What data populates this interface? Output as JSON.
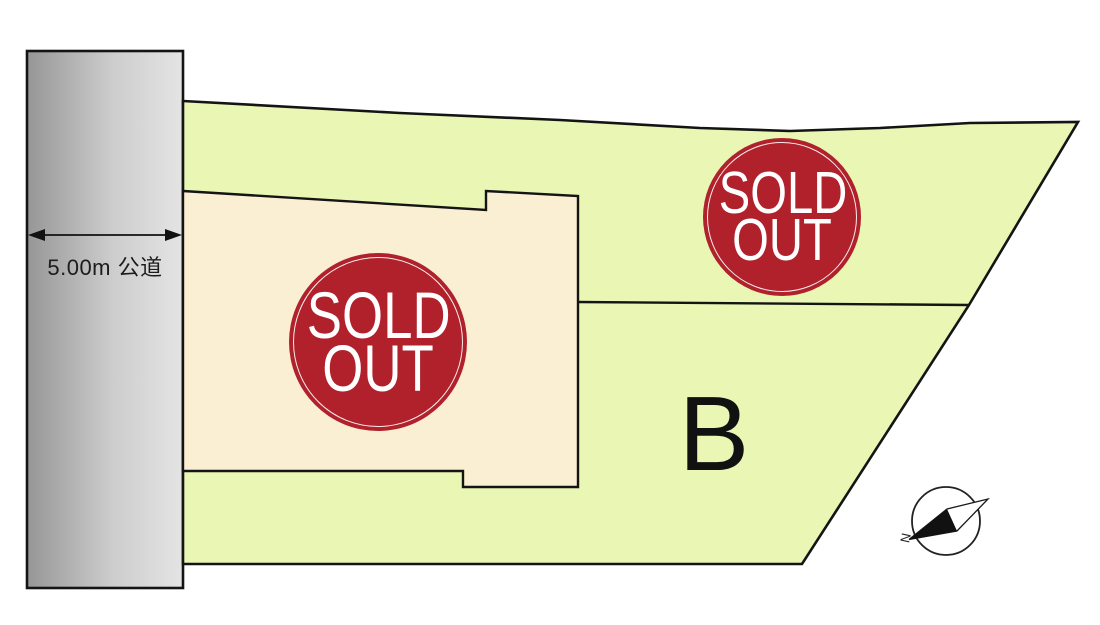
{
  "road": {
    "width_label": "5.00m 公道"
  },
  "lots": {
    "a": {
      "status_line1": "SOLD",
      "status_line2": "OUT"
    },
    "upper": {
      "status_line1": "SOLD",
      "status_line2": "OUT"
    },
    "b": {
      "label": "B"
    }
  },
  "compass": {
    "north_label": "N"
  },
  "colors": {
    "site_green": "#e9f6b4",
    "lot_cream": "#fbefd3",
    "badge_red": "#b0212c",
    "outline": "#141414",
    "road_gray_dark": "#969696",
    "road_gray_mid": "#cdcdcd",
    "road_gray_light": "#e4e4e4"
  }
}
